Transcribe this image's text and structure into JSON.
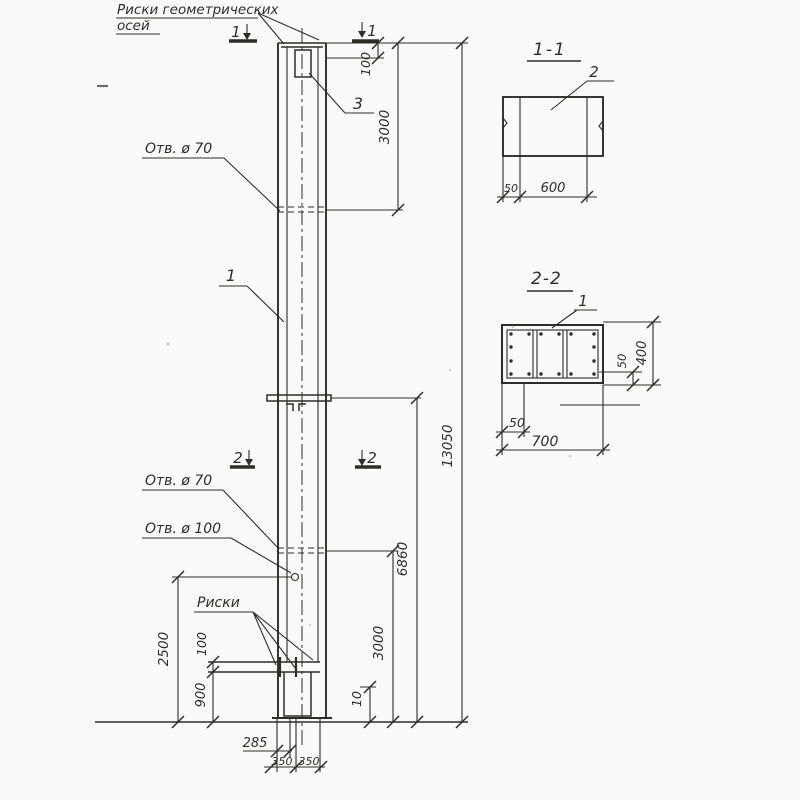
{
  "meta": {
    "paper_color": "#fbfaf8",
    "ink_color": "#2e2c29",
    "drawing_type": "reinforced concrete column elevation with sections"
  },
  "main": {
    "axis_marks_line1": "Риски геометрических",
    "axis_marks_line2": "осей",
    "cut1_left": "1",
    "cut1_right": "1",
    "cut2_left": "2",
    "cut2_right": "2",
    "pos_plate": "3",
    "pos_column": "1",
    "hole70_top": "Отв. ø 70",
    "hole70_bottom": "Отв. ø 70",
    "hole100": "Отв. ø 100",
    "riski": "Риски",
    "dim_100_top": "100",
    "dim_3000_top": "3000",
    "dim_13050": "13050",
    "dim_6860": "6860",
    "dim_3000_bottom": "3000",
    "dim_10": "10",
    "dim_2500": "2500",
    "dim_100_left": "100",
    "dim_900": "900",
    "dim_285": "285",
    "dim_350_l": "350",
    "dim_350_r": "350"
  },
  "s11": {
    "title": "1-1",
    "pos": "2",
    "dim_50": "50",
    "dim_600": "600"
  },
  "s22": {
    "title": "2-2",
    "pos": "1",
    "dim_400": "400",
    "dim_50_right": "50",
    "dim_50_bottom": "50",
    "dim_700": "700"
  }
}
